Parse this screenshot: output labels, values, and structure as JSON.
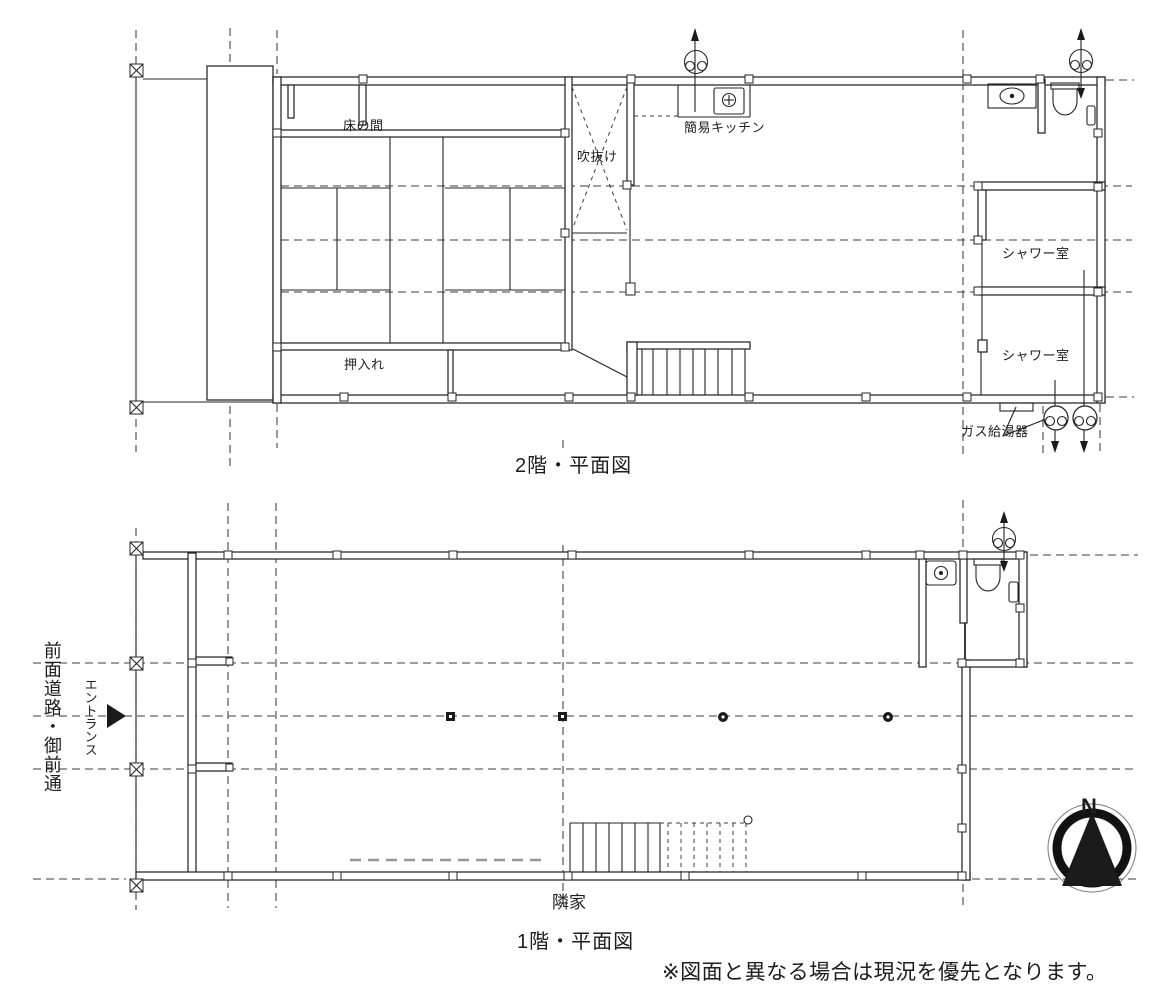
{
  "colors": {
    "ink": "#242424",
    "background": "#ffffff",
    "faint_line": "#979797"
  },
  "floor2": {
    "caption": "2階・平面図",
    "labels": {
      "tokonoma": "床の間",
      "atrium": "吹抜け",
      "kitchen": "簡易キッチン",
      "shower_upper": "シャワー室",
      "shower_lower": "シャワー室",
      "closet": "押入れ",
      "gas_heater": "ガス給湯器"
    }
  },
  "floor1": {
    "caption": "1階・平面図",
    "labels": {
      "front_road": "前面道路・御前通",
      "entrance": "エントランス",
      "neighbor": "隣家"
    }
  },
  "compass": {
    "north_label": "N"
  },
  "note": "※図面と異なる場合は現況を優先となります。"
}
